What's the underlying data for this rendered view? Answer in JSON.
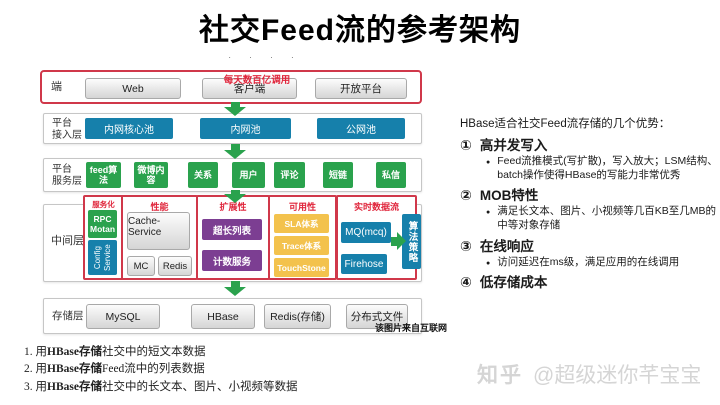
{
  "page": {
    "title": "社交Feed流的参考架构"
  },
  "diagram": {
    "artifact": "· · · ·",
    "annotation": "每天数百亿调用",
    "client_row": {
      "label": "端",
      "items": [
        "Web",
        "客户端",
        "开放平台"
      ]
    },
    "access_row": {
      "label1": "平台",
      "label2": "接入层",
      "items": [
        "内网核心池",
        "内网池",
        "公网池"
      ]
    },
    "service_row": {
      "label1": "平台",
      "label2": "服务层",
      "items": [
        "feed算法",
        "微博内容",
        "关系",
        "用户",
        "评论",
        "短链",
        "私信"
      ]
    },
    "middle_row": {
      "label": "中间层",
      "service_col": {
        "title": "服务化",
        "rpc": "RPC Motan",
        "config_line1": "Config",
        "config_line2": "Service"
      },
      "perf_col": {
        "title": "性能",
        "cache": "Cache-Service",
        "mc": "MC",
        "redis": "Redis"
      },
      "scale_col": {
        "title": "扩展性",
        "items": [
          "超长列表",
          "计数服务"
        ]
      },
      "avail_col": {
        "title": "可用性",
        "items": [
          "SLA体系",
          "Trace体系",
          "TouchStone"
        ]
      },
      "stream_col": {
        "title": "实时数据流",
        "items": [
          "MQ(mcq)",
          "Firehose"
        ],
        "side": "算法策略"
      }
    },
    "storage_row": {
      "label": "存储层",
      "items": [
        "MySQL",
        "HBase",
        "Redis(存储)",
        "分布式文件"
      ]
    },
    "source_note": "该图片来自互联网"
  },
  "advantages": {
    "heading": "HBase适合社交Feed流存储的几个优势：",
    "bullet": "●",
    "items": [
      {
        "num": "①",
        "title": "高并发写入",
        "detail": "Feed流推模式(写扩散)，写入放大；LSM结构、batch操作使得HBase的写能力非常优秀"
      },
      {
        "num": "②",
        "title": "MOB特性",
        "detail": "满足长文本、图片、小视频等几百KB至几MB的中等对象存储"
      },
      {
        "num": "③",
        "title": "在线响应",
        "detail": "访问延迟在ms级，满足应用的在线调用"
      },
      {
        "num": "④",
        "title": "低存储成本"
      }
    ]
  },
  "usage_notes": [
    {
      "prefix": "1. 用",
      "bold": "HBase存储",
      "rest": "社交中的短文本数据"
    },
    {
      "prefix": "2. 用",
      "bold": "HBase存储",
      "rest": "Feed流中的列表数据"
    },
    {
      "prefix": "3. 用",
      "bold": "HBase存储",
      "rest": "社交中的长文本、图片、小视频等数据"
    }
  ],
  "watermark": {
    "brand": "知乎",
    "handle": "@超级迷你芊宝宝"
  },
  "colors": {
    "red": "#d0384a",
    "teal": "#1680ab",
    "green": "#2aa24d",
    "purple": "#7c3e92",
    "yellow": "#f3c24d"
  }
}
